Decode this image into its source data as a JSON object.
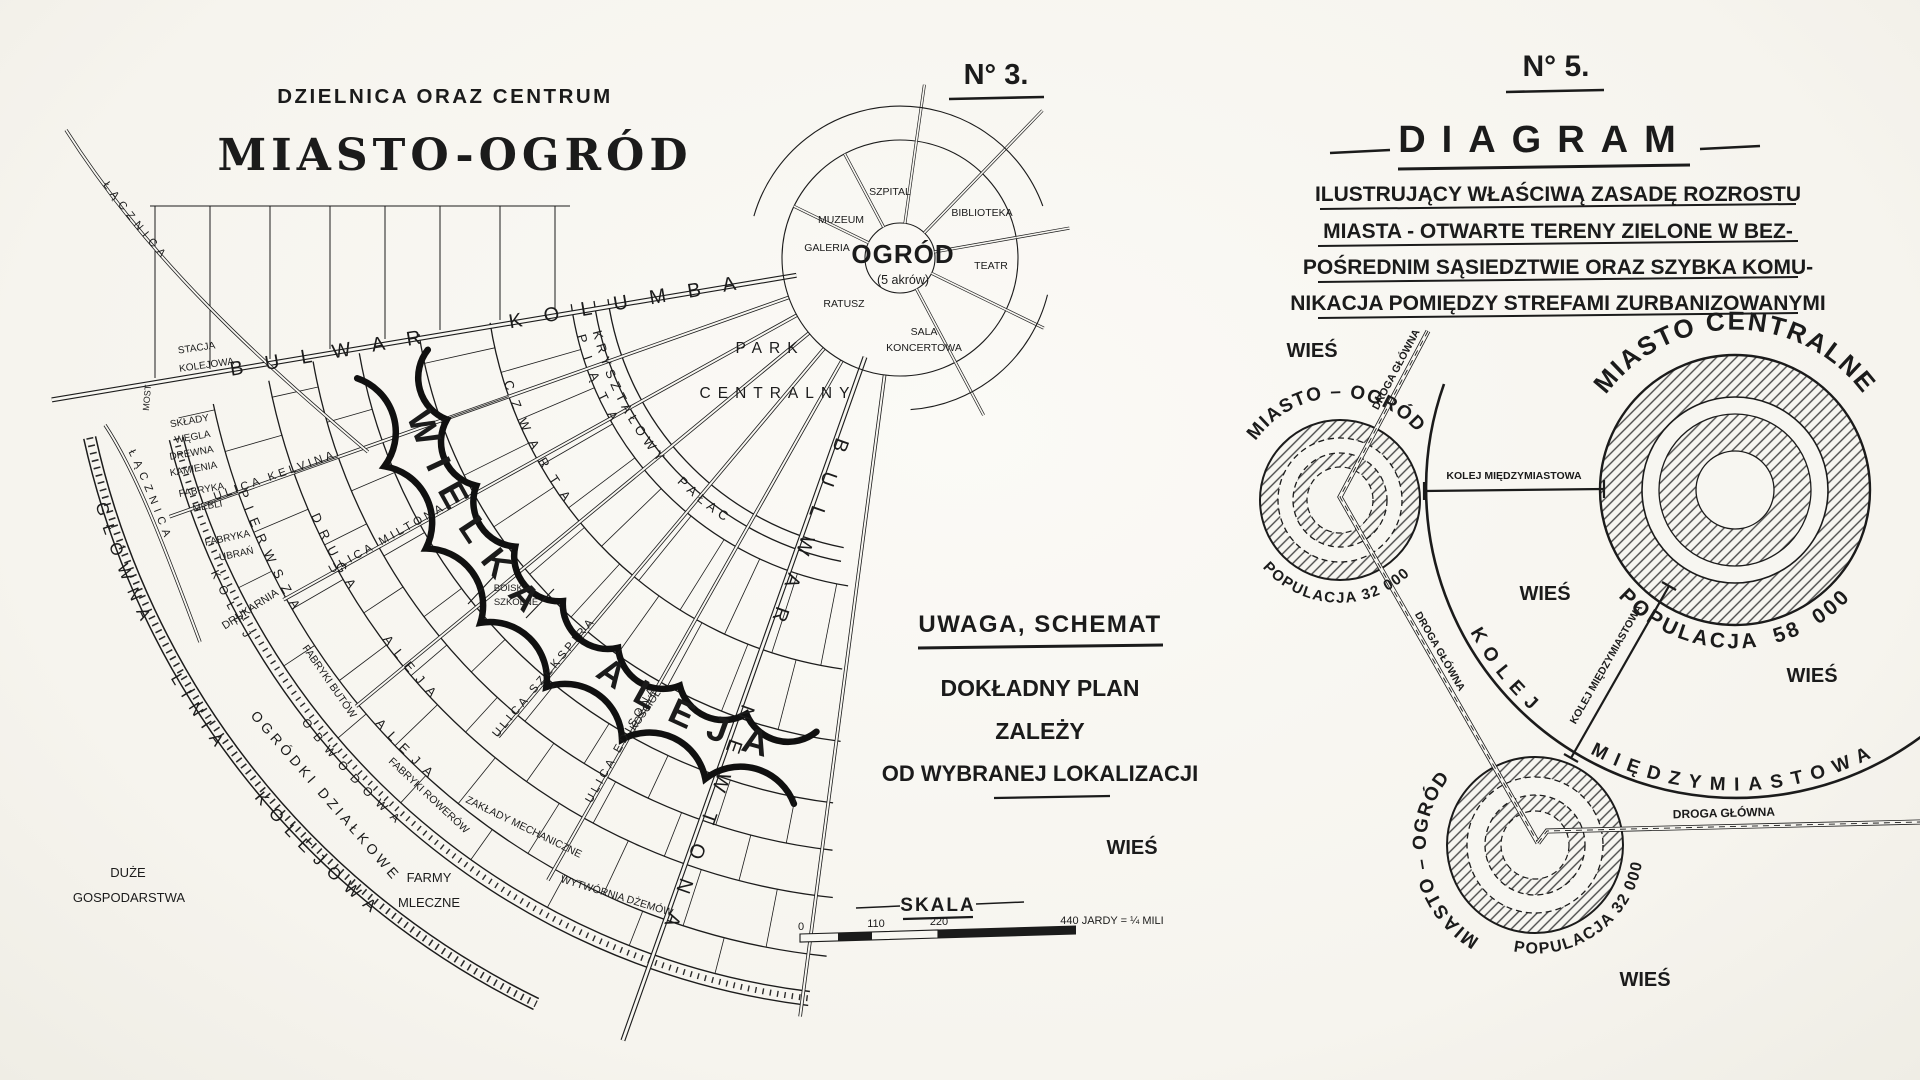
{
  "colors": {
    "paper": "#f7f6f1",
    "ink": "#1b1b1b"
  },
  "plan": {
    "no": "N° 3.",
    "title_top": "DZIELNICA ORAZ CENTRUM",
    "title_main": "MIASTO-OGRÓD",
    "hub": {
      "garden": "OGRÓD",
      "garden_area": "(5 akrów)",
      "szpital": "SZPITAL",
      "biblioteka": "BIBLIOTEKA",
      "muzeum": "MUZEUM",
      "galeria": "GALERIA",
      "ratusz": "RATUSZ",
      "teatr": "TEATR",
      "sala1": "SALA",
      "sala2": "KONCERTOWA"
    },
    "park1": "PARK",
    "park2": "CENTRALNY",
    "streets": {
      "kolumba": "BULWAR KOLUMBA",
      "newtona": "BULWAR NEWTONA",
      "krysztalowy": "KRYSZTAŁOWY PAŁAC",
      "wielka": "WIELKA ALEJA",
      "piata": "PIĄTA",
      "czwarta": "CZWARTA",
      "druga": "DRUGA ALEJA",
      "pierwsza": "PIERWSZA ALEJA",
      "kelvina": "ULICA KELVINA",
      "miltona": "ULICA MILTONA",
      "szekspira": "ULICA SZEKSPIRA",
      "edisona": "ULICA EDISONA",
      "obwodowa": "KOLEJ OBWODOWA",
      "glowna": "GŁÓWNA LINIA KOLEJOWA",
      "lacznica1": "ŁĄCZNICA",
      "lacznica2": "ŁĄCZNICA"
    },
    "sites": {
      "stacja1": "STACJA",
      "stacja2": "KOLEJOWA",
      "most": "MOST",
      "sklady1": "SKŁADY",
      "sklady2": "WĘGLA",
      "sklady3": "DREWNA",
      "sklady4": "KAMIENIA",
      "meble1": "FABRYKA",
      "meble2": "MEBLI",
      "ubrania1": "FABRYKA",
      "ubrania2": "UBRAŃ",
      "drukarnia": "DRUKARNIA",
      "buty": "FABRYKI BUTÓW",
      "rowery": "FABRYKI ROWERÓW",
      "zaklady": "ZAKŁADY MECHANICZNE",
      "dzemy": "WYTWÓRNIA DŻEMÓW",
      "boisko1": "BOISKO",
      "boisko2": "SZKOLNE",
      "kosciol": "KOŚCIÓŁ",
      "ogrodki": "OGRÓDKI DZIAŁKOWE",
      "duze1": "DUŻE",
      "duze2": "GOSPODARSTWA",
      "farmy1": "FARMY",
      "farmy2": "MLECZNE"
    },
    "note": {
      "l1": "UWAGA, SCHEMAT",
      "l2": "DOKŁADNY PLAN",
      "l3": "ZALEŻY",
      "l4": "OD WYBRANEJ LOKALIZACJI"
    },
    "scale": {
      "title": "SKALA",
      "t0": "0",
      "t1": "110",
      "t2": "220",
      "note": "440 JARDY = ¼ MILI"
    }
  },
  "diagram": {
    "no": "N° 5.",
    "title": "DIAGRAM",
    "sub1": "ILUSTRUJĄCY WŁAŚCIWĄ ZASADĘ ROZROSTU",
    "sub2": "MIASTA - OTWARTE TERENY ZIELONE W BEZ-",
    "sub3": "POŚREDNIM SĄSIEDZTWIE ORAZ SZYBKA KOMU-",
    "sub4": "NIKACJA POMIĘDZY STREFAMI ZURBANIZOWANYMI",
    "gc1_name": "MIASTO – OGRÓD",
    "gc1_pop": "POPULACJA  32 000",
    "central_name": "MIASTO CENTRALNE",
    "central_pop": "POPULACJA  58 000",
    "gc2_name": "MIASTO – OGRÓD",
    "gc2_pop": "POPULACJA  32 000",
    "rail_arc": "KOLEJ  MIĘDZYMIASTOWA",
    "rail_straight": "KOLEJ MIĘDZYMIASTOWA",
    "rail_diag": "KOLEJ MIĘDZYMIASTOWA",
    "road": "DROGA GŁÓWNA",
    "wies": "WIEŚ"
  }
}
